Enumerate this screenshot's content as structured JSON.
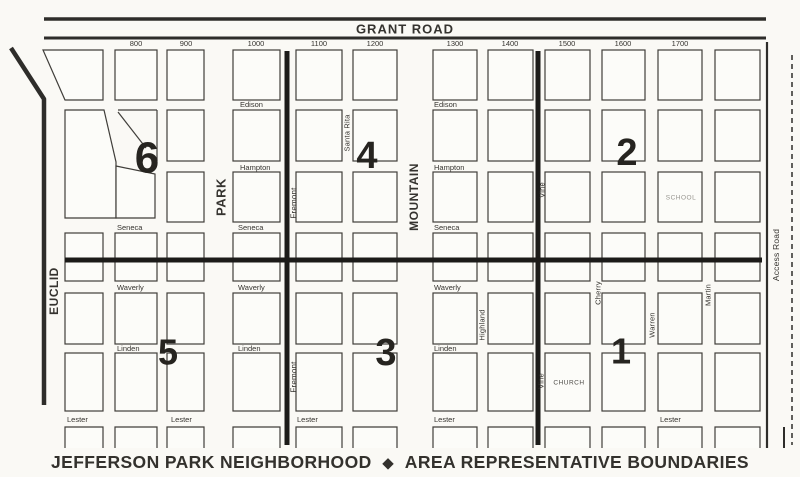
{
  "title": {
    "part1": "JEFFERSON PARK NEIGHBORHOOD",
    "separator": "◆",
    "part2": "AREA REPRESENTATIVE BOUNDARIES"
  },
  "map": {
    "top_road": "GRANT ROAD",
    "block_numbers": [
      {
        "label": "800",
        "x": 136
      },
      {
        "label": "900",
        "x": 186
      },
      {
        "label": "1000",
        "x": 256
      },
      {
        "label": "1100",
        "x": 319
      },
      {
        "label": "1200",
        "x": 375
      },
      {
        "label": "1300",
        "x": 455
      },
      {
        "label": "1400",
        "x": 510
      },
      {
        "label": "1500",
        "x": 567
      },
      {
        "label": "1600",
        "x": 623
      },
      {
        "label": "1700",
        "x": 680
      }
    ],
    "vertical_streets": [
      {
        "name": "EUCLID",
        "x": 54,
        "y": 291,
        "bold": true,
        "size": 12
      },
      {
        "name": "PARK",
        "x": 221,
        "y": 197,
        "bold": true,
        "size": 13
      },
      {
        "name": "Fremont",
        "x": 294,
        "y": 203,
        "bold": false,
        "size": 8
      },
      {
        "name": "Fremont",
        "x": 294,
        "y": 377,
        "bold": false,
        "size": 8
      },
      {
        "name": "Santa Rita",
        "x": 347,
        "y": 133,
        "bold": false,
        "size": 7.5
      },
      {
        "name": "MOUNTAIN",
        "x": 414,
        "y": 197,
        "bold": true,
        "size": 12
      },
      {
        "name": "Highland",
        "x": 482,
        "y": 325,
        "bold": false,
        "size": 7.5
      },
      {
        "name": "Vine",
        "x": 542,
        "y": 190,
        "bold": false,
        "size": 7.5
      },
      {
        "name": "Vine",
        "x": 541,
        "y": 381,
        "bold": false,
        "size": 7.5
      },
      {
        "name": "Cherry",
        "x": 598,
        "y": 293,
        "bold": false,
        "size": 7.5
      },
      {
        "name": "Warren",
        "x": 652,
        "y": 325,
        "bold": false,
        "size": 7.5
      },
      {
        "name": "Martin",
        "x": 708,
        "y": 295,
        "bold": false,
        "size": 7.5
      },
      {
        "name": "Access Road",
        "x": 776,
        "y": 255,
        "bold": false,
        "size": 8.5
      }
    ],
    "horizontal_streets": [
      {
        "name": "Edison",
        "x": 240,
        "y": 107
      },
      {
        "name": "Edison",
        "x": 434,
        "y": 107
      },
      {
        "name": "Hampton",
        "x": 240,
        "y": 170
      },
      {
        "name": "Hampton",
        "x": 434,
        "y": 170
      },
      {
        "name": "Seneca",
        "x": 117,
        "y": 230
      },
      {
        "name": "Seneca",
        "x": 238,
        "y": 230
      },
      {
        "name": "Seneca",
        "x": 434,
        "y": 230
      },
      {
        "name": "Waverly",
        "x": 117,
        "y": 290
      },
      {
        "name": "Waverly",
        "x": 238,
        "y": 290
      },
      {
        "name": "Waverly",
        "x": 434,
        "y": 290
      },
      {
        "name": "Linden",
        "x": 117,
        "y": 351
      },
      {
        "name": "Linden",
        "x": 238,
        "y": 351
      },
      {
        "name": "Linden",
        "x": 434,
        "y": 351
      },
      {
        "name": "Lester",
        "x": 67,
        "y": 422
      },
      {
        "name": "Lester",
        "x": 171,
        "y": 422
      },
      {
        "name": "Lester",
        "x": 297,
        "y": 422
      },
      {
        "name": "Lester",
        "x": 434,
        "y": 422
      },
      {
        "name": "Lester",
        "x": 660,
        "y": 422
      }
    ],
    "areas": [
      {
        "number": "6",
        "x": 147,
        "y": 158,
        "size": 44
      },
      {
        "number": "4",
        "x": 367,
        "y": 156,
        "size": 38
      },
      {
        "number": "2",
        "x": 627,
        "y": 153,
        "size": 38
      },
      {
        "number": "5",
        "x": 168,
        "y": 352,
        "size": 36
      },
      {
        "number": "3",
        "x": 386,
        "y": 353,
        "size": 38
      },
      {
        "number": "1",
        "x": 621,
        "y": 351,
        "size": 36
      }
    ],
    "landmarks": [
      {
        "name": "SCHOOL",
        "x": 681,
        "y": 198,
        "color": "#96948e"
      },
      {
        "name": "CHURCH",
        "x": 569,
        "y": 383,
        "color": "#4d4b47"
      }
    ],
    "geometry": {
      "grid": {
        "columns": [
          [
            65,
            103
          ],
          [
            115,
            157
          ],
          [
            167,
            204
          ],
          [
            233,
            280
          ],
          [
            296,
            342
          ],
          [
            353,
            397
          ],
          [
            433,
            477
          ],
          [
            488,
            533
          ],
          [
            545,
            590
          ],
          [
            602,
            645
          ],
          [
            658,
            702
          ],
          [
            715,
            760
          ]
        ],
        "rows": [
          [
            50,
            100
          ],
          [
            110,
            161
          ],
          [
            172,
            222
          ],
          [
            233,
            281
          ],
          [
            293,
            344
          ],
          [
            353,
            411
          ],
          [
            427,
            448
          ]
        ],
        "skip_cells": [
          "0-0",
          "0-1",
          "0-2",
          "1-1",
          "1-2"
        ]
      },
      "special_polygons": [
        "43,50 103,50 103,100 65,100",
        "65,110 104,110 116,162 116,218 65,218",
        "116,166 155,174 155,218 116,218"
      ],
      "special_segments": [
        [
          118,
          110,
          157,
          110
        ],
        [
          157,
          110,
          157,
          161
        ],
        [
          118,
          112,
          146,
          148
        ]
      ],
      "roads": [
        {
          "d": "M44,19 H766",
          "w": 3.5
        },
        {
          "d": "M44,38 H766",
          "w": 3
        },
        {
          "d": "M11,48 L44,99 V405",
          "w": 4.5
        },
        {
          "d": "M767,42 V448",
          "w": 2.2
        },
        {
          "d": "M792,55 V445",
          "w": 1.5,
          "dash": "5 4"
        },
        {
          "d": "M784,427 V448",
          "w": 2
        }
      ],
      "boundaries": [
        {
          "d": "M65,260 H762"
        },
        {
          "d": "M287,51 V445"
        },
        {
          "d": "M538,51 V445"
        }
      ],
      "grant_label_pos": {
        "x": 405,
        "y": 29
      }
    },
    "colors": {
      "paper": "#faf9f5",
      "block_fill": "#fcfcf9",
      "line": "#403e3a",
      "road": "#2e2d2a",
      "boundary": "#1c1b19",
      "text": "#35332f",
      "area_number": "#262420"
    }
  }
}
